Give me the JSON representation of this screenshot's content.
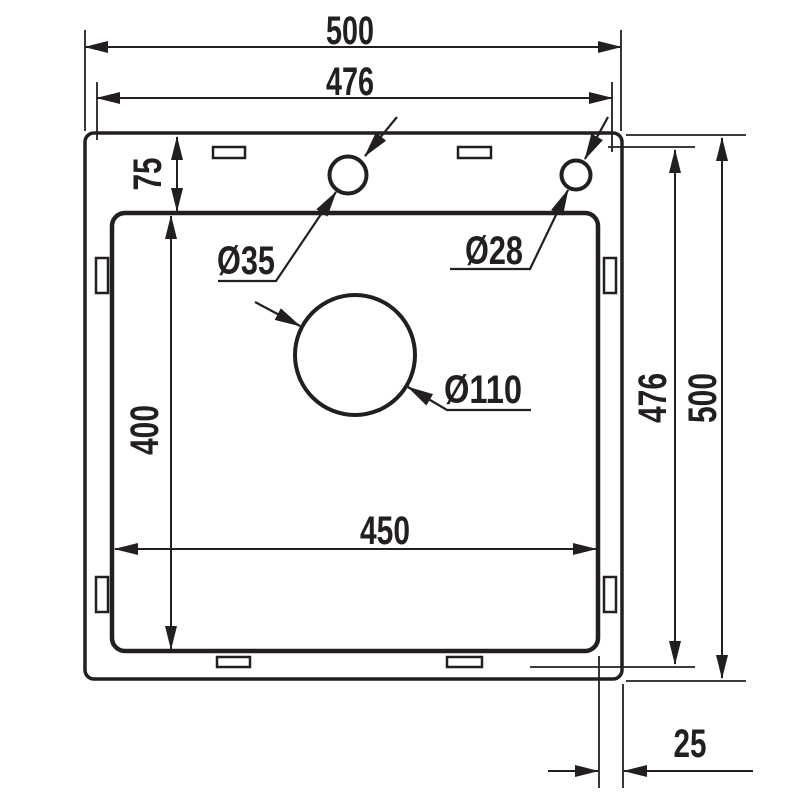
{
  "drawing": {
    "background_color": "#ffffff",
    "line_color": "#231f20",
    "dimensions": {
      "overall_width": "500",
      "cutout_width": "476",
      "rim_top_offset": "75",
      "bowl_length": "400",
      "bowl_width": "450",
      "cutout_height": "476",
      "overall_height": "500",
      "edge_offset": "25"
    },
    "holes": {
      "faucet_hole": "Ø35",
      "accessory_hole": "Ø28",
      "drain_hole": "Ø110"
    }
  }
}
